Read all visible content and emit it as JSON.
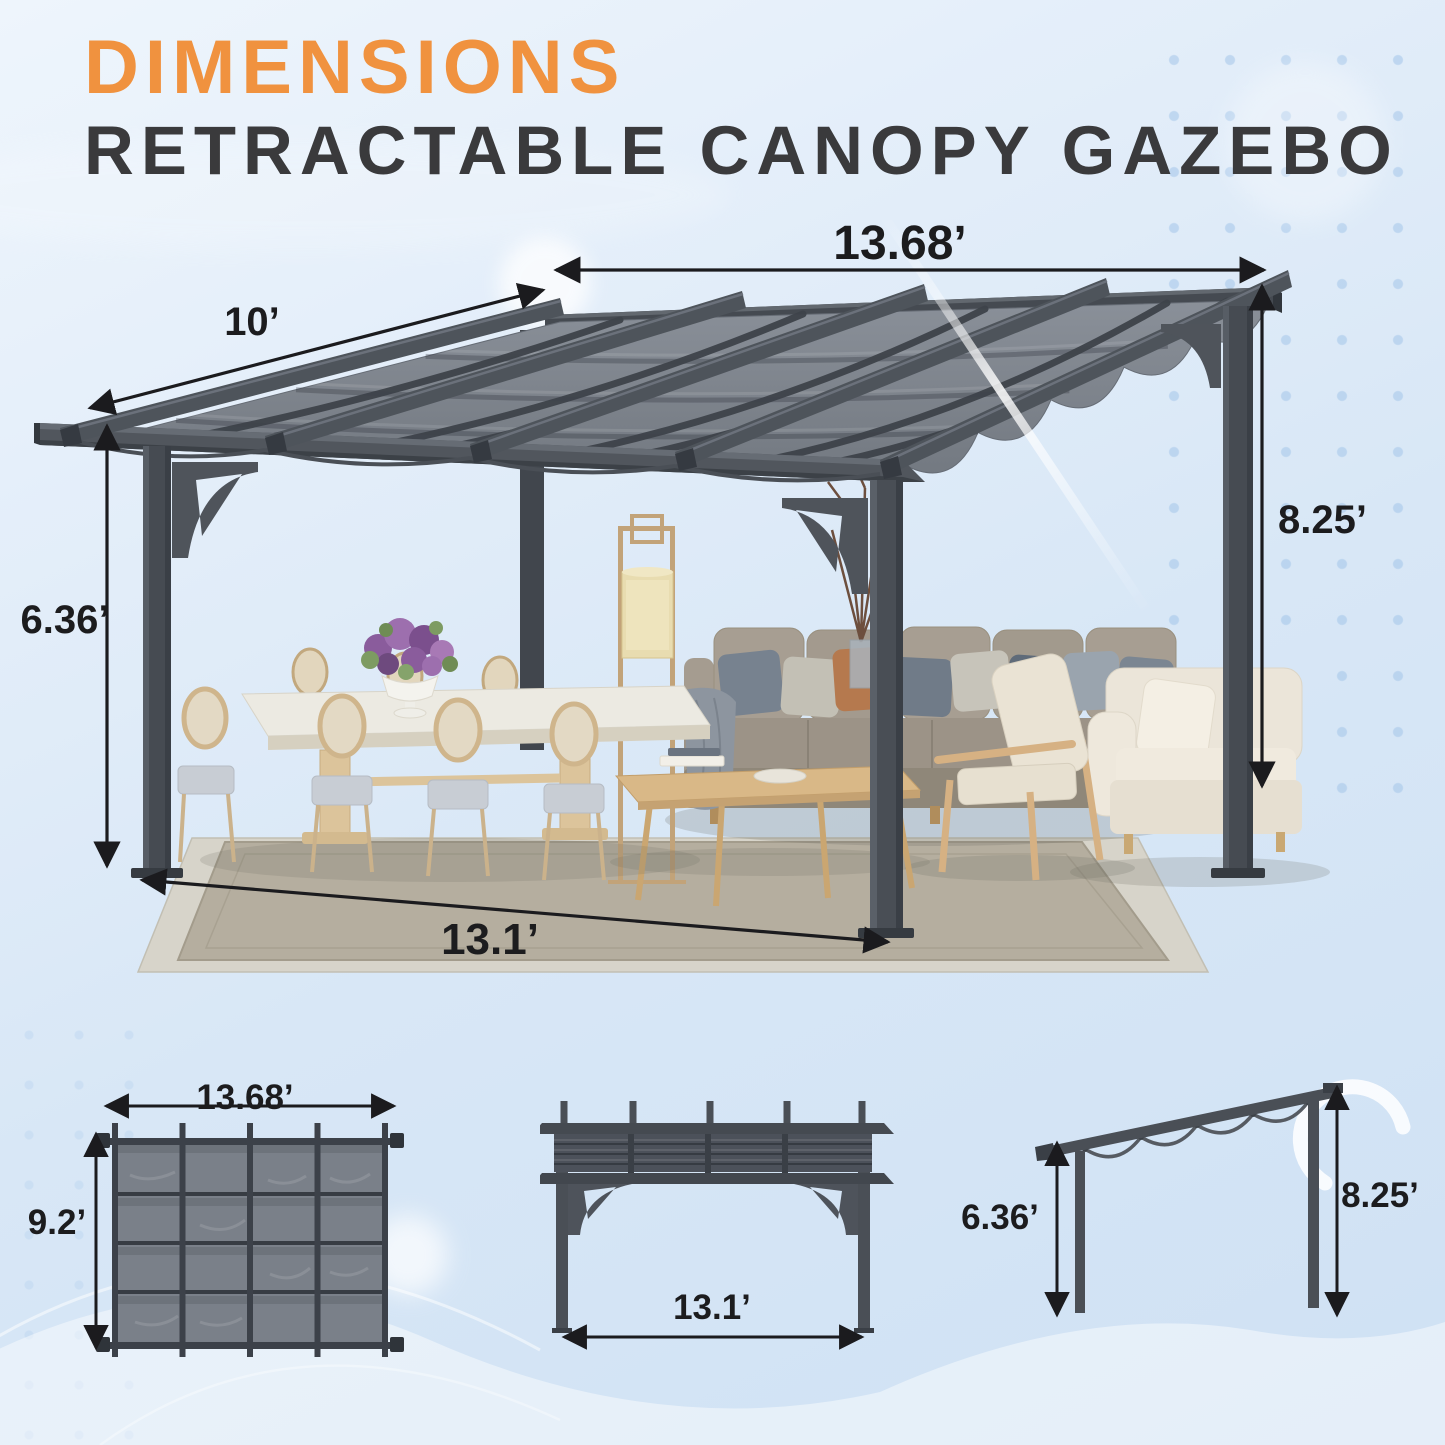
{
  "header": {
    "title": "DIMENSIONS",
    "subtitle": "RETRACTABLE CANOPY GAZEBO"
  },
  "main_view": {
    "dimensions": {
      "canopy_length": "13.68’",
      "rafter_depth": "10’",
      "back_height": "8.25’",
      "front_height": "6.36’",
      "post_spacing": "13.1’"
    }
  },
  "top_view": {
    "dimensions": {
      "length": "13.68’",
      "width": "9.2’"
    }
  },
  "front_view": {
    "dimensions": {
      "width": "13.1’"
    }
  },
  "side_view": {
    "dimensions": {
      "front_height": "6.36’",
      "back_height": "8.25’"
    }
  },
  "colors": {
    "accent_orange": "#F0923F",
    "heading": "#3A3A3C",
    "dimension_text": "#1C1C1E",
    "frame_gray": "#4A4F56",
    "canopy_gray": "#7D838C",
    "background_blue": "#DCE9F7"
  }
}
